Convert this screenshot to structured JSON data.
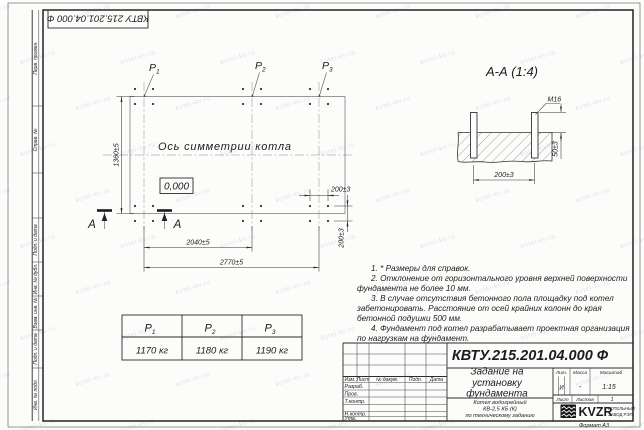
{
  "watermark": "kotel-kv.ru",
  "stamp_top": "КВТУ 215.201.04.000 Ф",
  "margin_labels": [
    "Перв. примен.",
    "Справ. №",
    "Подп. и дата",
    "Инв. № дубл.",
    "Взам. инв. №",
    "Подп. и дата",
    "Инв. № подл."
  ],
  "plan": {
    "points": [
      {
        "base": "P",
        "sub": "1"
      },
      {
        "base": "P",
        "sub": "2"
      },
      {
        "base": "P",
        "sub": "3"
      }
    ],
    "axis_label": "Ось симметрии котла",
    "level_mark": "0,000",
    "section_letter": "А",
    "dims": {
      "height": "1360±5",
      "span1": "2040±5",
      "span_total": "2770±5",
      "bolt_x": "200±3",
      "bolt_y": "200±3"
    }
  },
  "section": {
    "title": "А-А (1:4)",
    "thread": "М16",
    "dim_width": "200±3",
    "dim_protrusion": "50±3"
  },
  "notes": [
    "1. * Размеры для справок.",
    "2. Отклонение от горизонтального уровня верхней поверхности фундамента не более 10 мм.",
    "3. В случае отсутствия бетонного пола площадку под котел забетонировать. Расстояние от осей крайних колонн до края бетонной подушки 500 мм.",
    "4. Фундамент под котел разрабатывает проектная организация по нагрузкам на фундамент."
  ],
  "load_table": {
    "headers": [
      {
        "base": "P",
        "sub": "1"
      },
      {
        "base": "P",
        "sub": "2"
      },
      {
        "base": "P",
        "sub": "3"
      }
    ],
    "values": [
      "1170 кг",
      "1180 кг",
      "1190 кг"
    ]
  },
  "titleblock": {
    "code": "КВТУ.215.201.04.000 Ф",
    "title_lines": [
      "Задание на",
      "установку",
      "фундамента"
    ],
    "product_lines": [
      "Котел водогрейный",
      "КВ-2,5 КБ (К)",
      "по техническому заданию"
    ],
    "cols": {
      "izm": "Изм.",
      "list": "Лист",
      "doc": "№ докум.",
      "sign": "Подп.",
      "date": "Дата"
    },
    "rows": {
      "dev": "Разраб.",
      "check": "Пров.",
      "tcontr": "Т.контр.",
      "ncontr": "Н.контр.",
      "approve": "Утв."
    },
    "lit_label": "Лит.",
    "mass_label": "Масса",
    "scale_label": "Масштаб",
    "lit_value": "И",
    "mass_value": "-",
    "scale_value": "1:15",
    "sheet_label": "Лист",
    "sheets_label": "Листов",
    "sheets_value": "1",
    "logo_text": "KVZR",
    "company_line1": "КОТЕЛЬНЫЙ",
    "company_line2": "ЗАВОД РЭП",
    "format": "Формат А3"
  }
}
